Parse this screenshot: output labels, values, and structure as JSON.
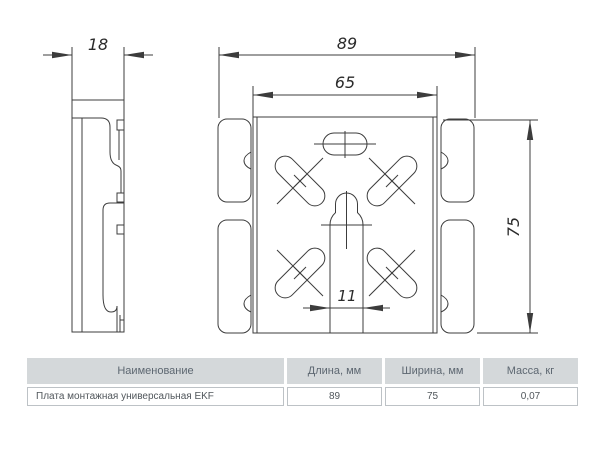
{
  "drawing": {
    "dim_thickness": "18",
    "dim_overall_width": "89",
    "dim_inner_width": "65",
    "dim_height": "75",
    "dim_slot_width": "11"
  },
  "table": {
    "headers": [
      "Наименование",
      "Длина, мм",
      "Ширина, мм",
      "Масса, кг"
    ],
    "row": [
      "Плата монтажная универсальная EKF",
      "89",
      "75",
      "0,07"
    ]
  },
  "colors": {
    "drawing_line": "#3c3c3c",
    "dimension_text": "#2b2b2b",
    "table_header_bg": "#d4d8da",
    "table_header_text": "#5d6771",
    "table_row_text": "#50565b",
    "table_row_border": "#bdc2c6"
  }
}
